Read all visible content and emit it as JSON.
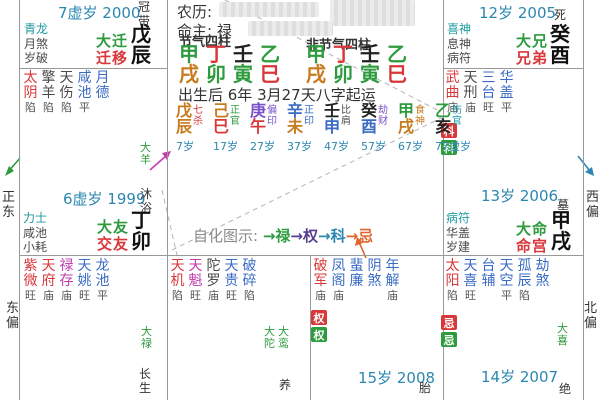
{
  "palette": {
    "red": "#d8383a",
    "green": "#2e9b3f",
    "blue": "#3a6bc5",
    "teal": "#1d9aa2",
    "magenta": "#c43bb0",
    "dark": "#4a4a4a",
    "gray": "#8a8a8a",
    "year_blue": "#2b87b0",
    "wood": "#2e9b3f",
    "fire": "#d8383a",
    "earth": "#c87a1e",
    "metal": "#7a52c8",
    "metal_blue": "#3a6bc5",
    "water": "#222222",
    "quan": "#54408c",
    "ke": "#2b87b0",
    "ji": "#e0662e",
    "badge_red": "#d8383a",
    "badge_green": "#2e9b3f",
    "border": "#999999",
    "dash": "#b5b5b5"
  },
  "margins": {
    "left_top": "正东",
    "left_bottom": "东偏",
    "right_top": "西偏",
    "right_bottom": "北偏"
  },
  "center": {
    "lunar_label": "农历:",
    "mingzhu_label": "命主: 禄",
    "jieqi_label": "节气四柱",
    "fei_jieqi_label": "非节气四柱",
    "jieqi_pillars": [
      {
        "stem": "甲",
        "sc": "wood",
        "branch": "戌",
        "bc": "earth"
      },
      {
        "stem": "丁",
        "sc": "fire",
        "branch": "卯",
        "bc": "wood"
      },
      {
        "stem": "壬",
        "sc": "water",
        "branch": "寅",
        "bc": "wood"
      },
      {
        "stem": "乙",
        "sc": "wood",
        "branch": "巳",
        "bc": "fire"
      }
    ],
    "fei_jieqi_pillars": [
      {
        "stem": "甲",
        "sc": "wood",
        "branch": "戌",
        "bc": "earth"
      },
      {
        "stem": "丁",
        "sc": "fire",
        "branch": "卯",
        "bc": "wood"
      },
      {
        "stem": "壬",
        "sc": "water",
        "branch": "寅",
        "bc": "wood"
      },
      {
        "stem": "乙",
        "sc": "wood",
        "branch": "巳",
        "bc": "fire"
      }
    ],
    "birth_line": "出生后 6年 3月27天八字起运",
    "luck_pillars": [
      {
        "stem": "戊",
        "sc": "earth",
        "branch": "辰",
        "bc": "earth",
        "god": "七杀",
        "gc": "fire",
        "age": "7岁"
      },
      {
        "stem": "己",
        "sc": "earth",
        "branch": "巳",
        "bc": "fire",
        "god": "正官",
        "gc": "green",
        "age": "17岁"
      },
      {
        "stem": "庚",
        "sc": "metal",
        "branch": "午",
        "bc": "fire",
        "god": "偏印",
        "gc": "metal",
        "age": "27岁"
      },
      {
        "stem": "辛",
        "sc": "metal_blue",
        "branch": "未",
        "bc": "earth",
        "god": "正印",
        "gc": "blue",
        "age": "37岁"
      },
      {
        "stem": "壬",
        "sc": "water",
        "branch": "申",
        "bc": "metal_blue",
        "god": "比肩",
        "gc": "dark",
        "age": "47岁"
      },
      {
        "stem": "癸",
        "sc": "water",
        "branch": "酉",
        "bc": "metal_blue",
        "god": "劫财",
        "gc": "metal",
        "age": "57岁"
      },
      {
        "stem": "甲",
        "sc": "wood",
        "branch": "戌",
        "bc": "earth",
        "god": "食神",
        "gc": "earth",
        "age": "67岁"
      },
      {
        "stem": "乙",
        "sc": "wood",
        "branch": "亥",
        "bc": "water",
        "god": "伤官",
        "gc": "teal",
        "age": "77虚岁"
      }
    ],
    "zihua_label": "自化图示:",
    "zihua_items": [
      {
        "text": "→禄",
        "c": "green"
      },
      {
        "text": "→权",
        "c": "quan"
      },
      {
        "text": "→科",
        "c": "ke"
      },
      {
        "text": "→忌",
        "c": "ji"
      }
    ]
  },
  "palaces": {
    "top_left": {
      "year": "7虚岁 2000",
      "stage": "冠带",
      "gods": [
        "青龙",
        "月煞",
        "岁破"
      ],
      "da": "大迁",
      "name": "迁移",
      "ganzhi": "戊辰"
    },
    "top_right": {
      "year": "12岁 2005",
      "stage": "死",
      "gods": [
        "喜神",
        "息神",
        "病符"
      ],
      "da": "大兄",
      "name": "兄弟",
      "ganzhi": "癸酉"
    },
    "mid_left": {
      "stars": [
        {
          "n": "太阴",
          "c": "red",
          "s": "陷"
        },
        {
          "n": "擎羊",
          "c": "dark",
          "s": "陷"
        },
        {
          "n": "天伤",
          "c": "dark",
          "s": "陷"
        },
        {
          "n": "咸池",
          "c": "blue",
          "s": "平"
        },
        {
          "n": "月德",
          "c": "blue",
          "s": ""
        }
      ],
      "flow": "大羊",
      "year": "6虚岁 1999",
      "stage": "沐浴",
      "gods": [
        "力士",
        "咸池",
        "小耗"
      ],
      "da": "大友",
      "name": "交友",
      "ganzhi": "丁卯"
    },
    "mid_right": {
      "stars": [
        {
          "n": "武曲",
          "c": "red",
          "s": "庙"
        },
        {
          "n": "天刑",
          "c": "dark",
          "s": "庙"
        },
        {
          "n": "三台",
          "c": "blue",
          "s": "旺"
        },
        {
          "n": "华盖",
          "c": "blue",
          "s": "平"
        }
      ],
      "badges": [
        {
          "t": "科",
          "bg": "badge_red"
        },
        {
          "t": "科",
          "bg": "badge_green"
        }
      ],
      "year": "13岁 2006",
      "stage": "墓",
      "gods": [
        "病符",
        "华盖",
        "岁建"
      ],
      "da": "大命",
      "name": "命宫",
      "ganzhi": "甲戌"
    },
    "bottom_left": {
      "stars": [
        {
          "n": "紫微",
          "c": "red",
          "s": "旺"
        },
        {
          "n": "天府",
          "c": "red",
          "s": "庙"
        },
        {
          "n": "禄存",
          "c": "magenta",
          "s": "庙"
        },
        {
          "n": "天姚",
          "c": "blue",
          "s": "旺"
        },
        {
          "n": "龙池",
          "c": "blue",
          "s": "平"
        }
      ],
      "flow": "大禄",
      "stage": "长生"
    },
    "bottom_mid_left": {
      "stars": [
        {
          "n": "天机",
          "c": "red",
          "s": "陷"
        },
        {
          "n": "天魁",
          "c": "magenta",
          "s": "旺"
        },
        {
          "n": "陀罗",
          "c": "dark",
          "s": "庙"
        },
        {
          "n": "天贵",
          "c": "blue",
          "s": "旺"
        },
        {
          "n": "破碎",
          "c": "blue",
          "s": "陷"
        }
      ],
      "flows": [
        "大陀",
        "大鸾"
      ],
      "stage": "养"
    },
    "bottom_mid_right": {
      "stars": [
        {
          "n": "破军",
          "c": "red",
          "s": "庙"
        },
        {
          "n": "凤阁",
          "c": "blue",
          "s": "庙"
        },
        {
          "n": "蜚廉",
          "c": "blue",
          "s": ""
        },
        {
          "n": "阴煞",
          "c": "blue",
          "s": ""
        },
        {
          "n": "年解",
          "c": "blue",
          "s": "庙"
        }
      ],
      "badges": [
        {
          "t": "权",
          "bg": "badge_red"
        },
        {
          "t": "权",
          "bg": "badge_green"
        }
      ],
      "year": "15岁 2008",
      "stage": "胎"
    },
    "bottom_right": {
      "stars": [
        {
          "n": "太阳",
          "c": "red",
          "s": "陷"
        },
        {
          "n": "天喜",
          "c": "blue",
          "s": "旺"
        },
        {
          "n": "台辅",
          "c": "blue",
          "s": ""
        },
        {
          "n": "天空",
          "c": "blue",
          "s": "平"
        },
        {
          "n": "孤辰",
          "c": "blue",
          "s": "陷"
        },
        {
          "n": "劫煞",
          "c": "blue",
          "s": ""
        }
      ],
      "badges": [
        {
          "t": "忌",
          "bg": "badge_red"
        },
        {
          "t": "忌",
          "bg": "badge_green"
        }
      ],
      "flow": "大喜",
      "year": "14岁 2007",
      "stage": "绝"
    }
  }
}
